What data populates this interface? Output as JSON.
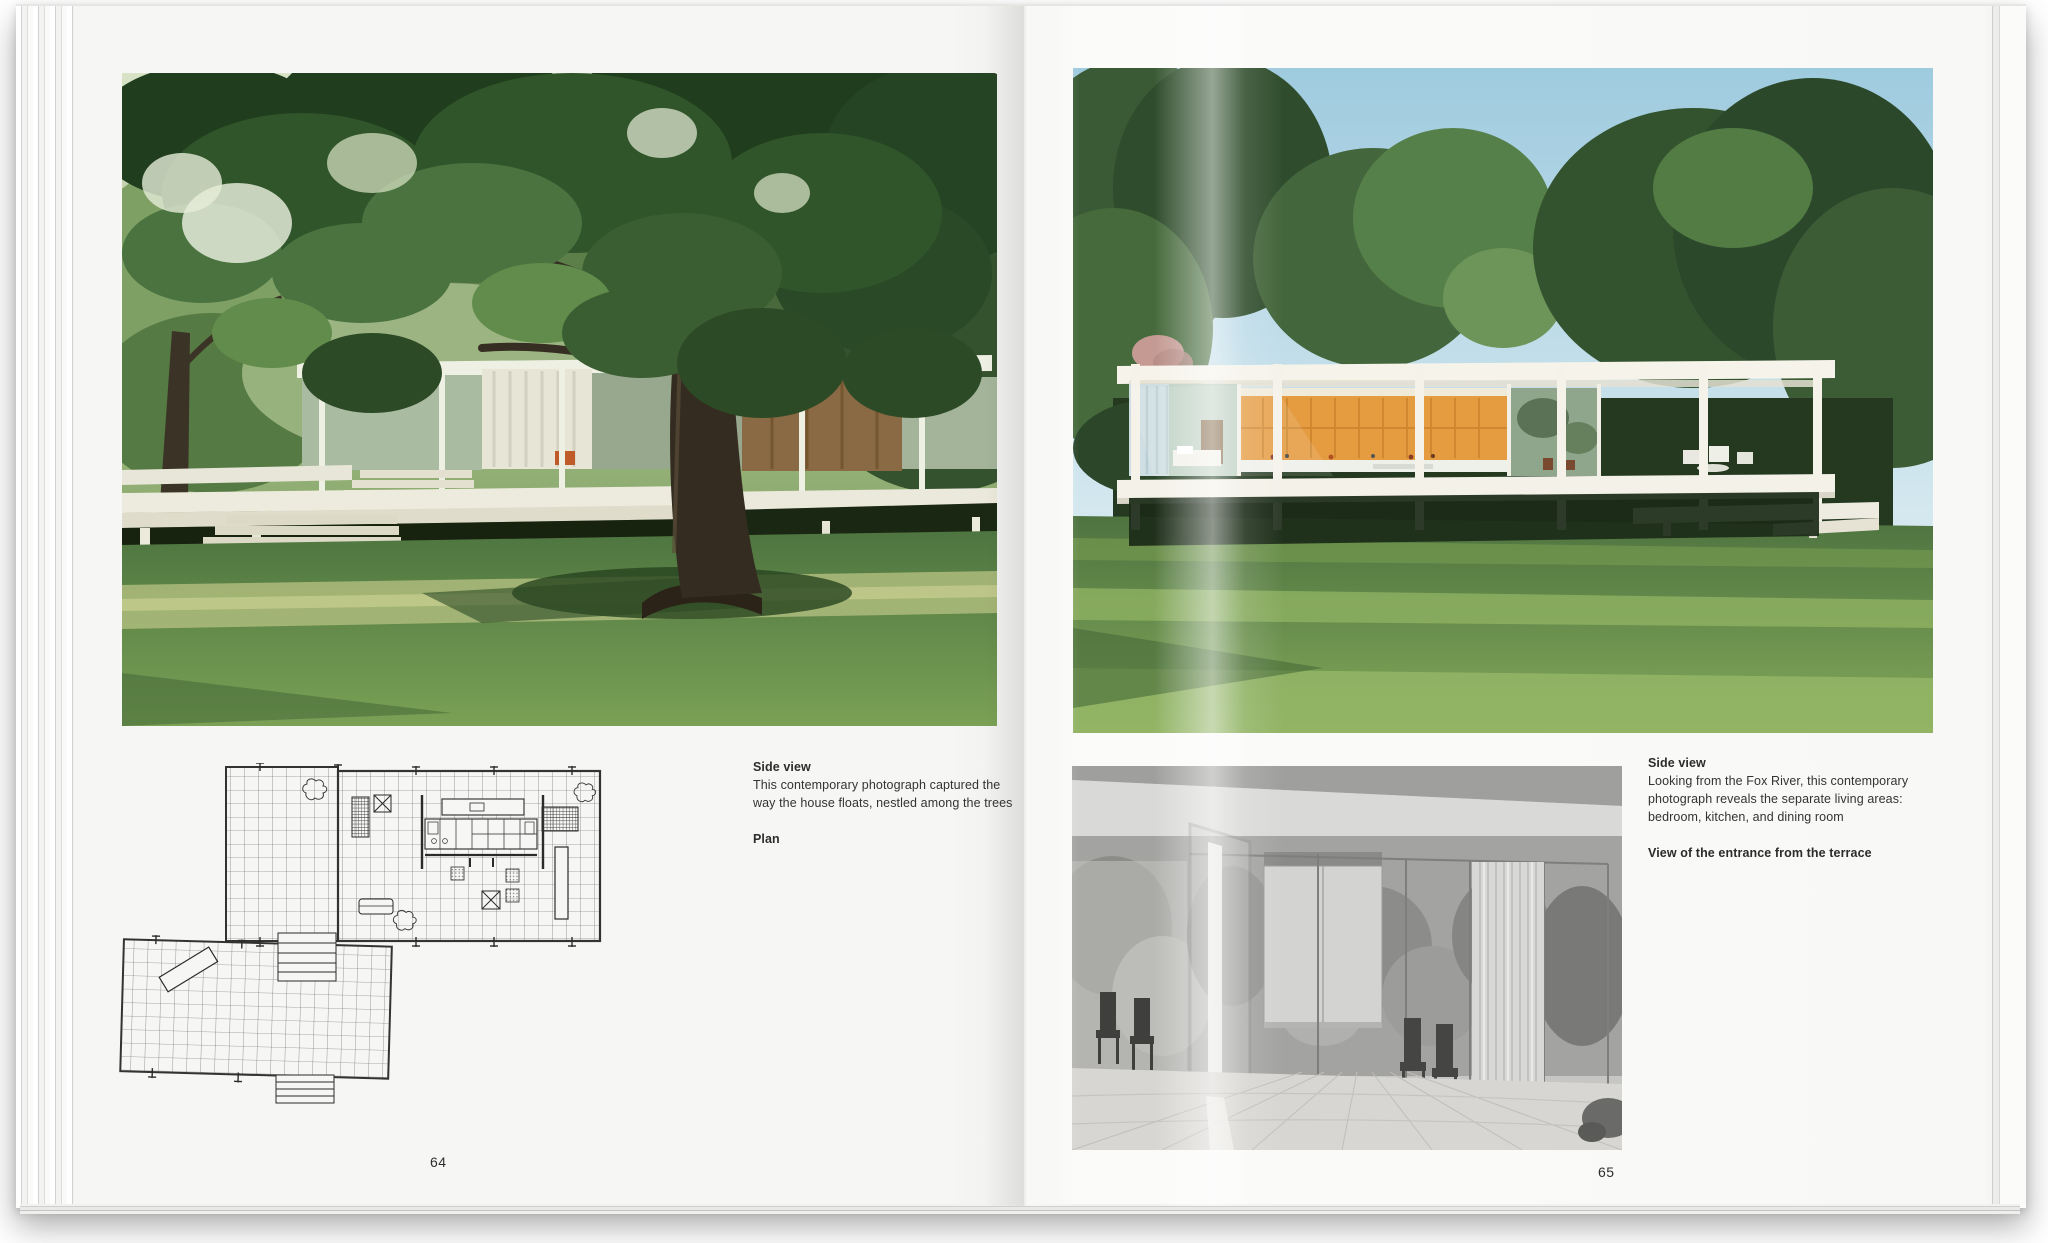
{
  "spread": {
    "left_page": {
      "page_number": "64",
      "captions": {
        "photo_title": "Side view",
        "photo_body_line1": "This contemporary photograph captured the",
        "photo_body_line2": "way the house floats, nestled among the trees",
        "plan_title": "Plan"
      }
    },
    "right_page": {
      "page_number": "65",
      "captions": {
        "photo_title": "Side view",
        "photo_body_line1": "Looking from the Fox River, this contemporary",
        "photo_body_line2": "photograph reveals the separate living areas:",
        "photo_body_line3": "bedroom, kitchen, and dining room",
        "interior_title": "View of the entrance from the terrace"
      }
    },
    "colors": {
      "page_paper": "#f7f7f5",
      "caption_text": "#333331",
      "sky_blue": "#a5cfe0",
      "lawn_green": "#6c9153",
      "canopy_green": "#35552c",
      "house_white": "#f3f1e8",
      "kitchen_wood_orange": "#e59b40",
      "plan_ink": "#3a3a38"
    }
  }
}
